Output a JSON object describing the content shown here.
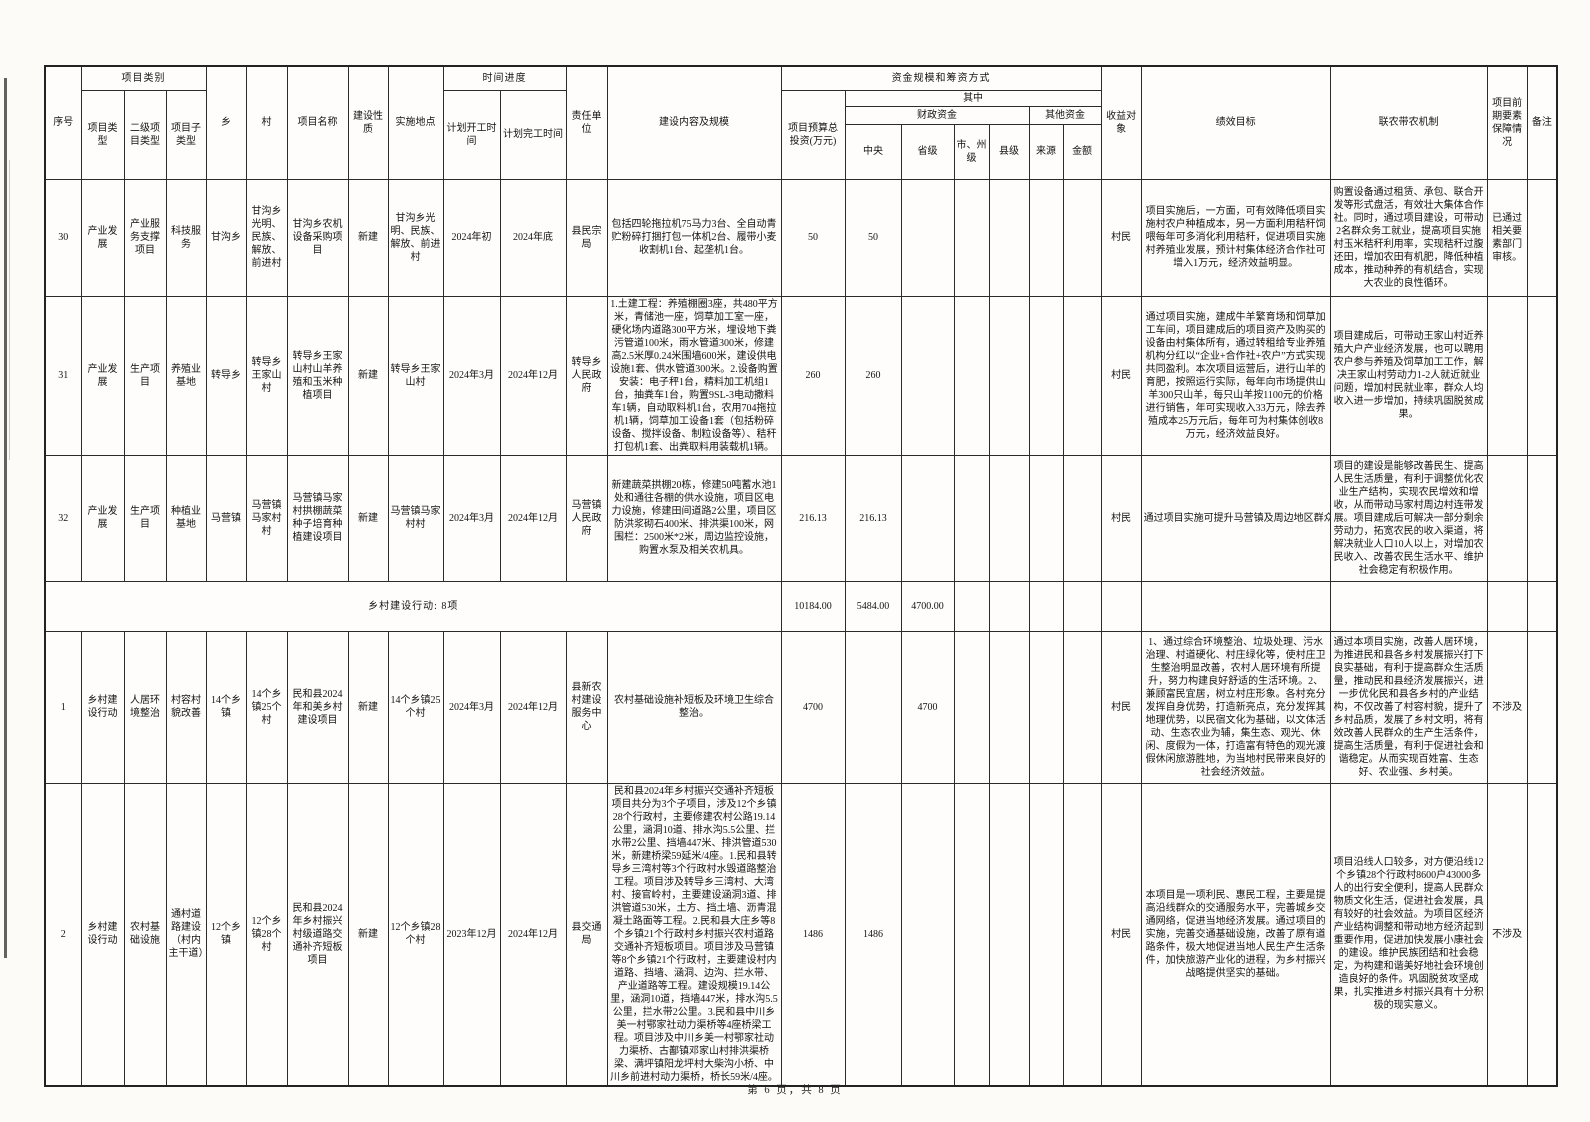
{
  "document": {
    "footer_page": "第 6 页，共 8 页"
  },
  "table": {
    "header": {
      "seq": "序号",
      "category_group": "项目类别",
      "project_type": "项目类型",
      "secondary_type": "二级项目类型",
      "sub_type": "项目子类型",
      "township": "乡",
      "village": "村",
      "project_name": "项目名称",
      "nature": "建设性质",
      "location": "实施地点",
      "schedule_group": "时间进度",
      "plan_start": "计划开工时间",
      "plan_finish": "计划完工时间",
      "responsible_unit": "责任单位",
      "content_scale": "建设内容及规模",
      "funding_group": "资金规模和筹资方式",
      "budget_total": "项目预算总投资(万元)",
      "including": "其中",
      "fiscal_funds": "财政资金",
      "central": "中央",
      "provincial": "省级",
      "city_level": "市、州级",
      "county_level": "县级",
      "other_funds": "其他资金",
      "source": "来源",
      "amount": "金额",
      "beneficiary": "收益对象",
      "performance_goal": "绩效目标",
      "mechanism": "联农带农机制",
      "preparation": "项目前期要素保障情况",
      "remark": "备注"
    },
    "rows": [
      {
        "seq": "30",
        "type": "产业发展",
        "secondary": "产业服务支撑项目",
        "subtype": "科技服务",
        "township": "甘沟乡",
        "village": "甘沟乡光明、民族、解放、前进村",
        "name": "甘沟乡农机设备采购项目",
        "nature": "新建",
        "location": "甘沟乡光明、民族、解放、前进村",
        "start": "2024年初",
        "finish": "2024年底",
        "unit": "县民宗局",
        "content": "包括四轮拖拉机75马力3台、全自动青贮粉碎打捆打包一体机2台、履带小麦收割机1台、起垄机1台。",
        "budget": "50",
        "central": "50",
        "provincial": "",
        "city": "",
        "county": "",
        "source": "",
        "amount": "",
        "beneficiary": "村民",
        "performance": "项目实施后，一方面，可有效降低项目实施村农户种植成本，另一方面利用秸秆饲喂每年可多消化利用秸秆，促进项目实施村养殖业发展，预计村集体经济合作社可增入1万元，经济效益明显。",
        "mechanism": "购置设备通过租赁、承包、联合开发等形式盘活，有效壮大集体合作社。同时，通过项目建设，可带动2名群众务工就业，提高项目实施村玉米秸秆利用率，实现秸秆过腹还田，增加农田有机肥，降低种植成本，推动种养的有机结合，实现大农业的良性循环。",
        "preparation": "已通过相关要素部门审核。",
        "remark": ""
      },
      {
        "seq": "31",
        "type": "产业发展",
        "secondary": "生产项目",
        "subtype": "养殖业基地",
        "township": "转导乡",
        "village": "转导乡王家山村",
        "name": "转导乡王家山村山羊养殖和玉米种植项目",
        "nature": "新建",
        "location": "转导乡王家山村",
        "start": "2024年3月",
        "finish": "2024年12月",
        "unit": "转导乡人民政府",
        "content": "1.土建工程：养殖棚圈3座，共480平方米，青储池一座，饲草加工室一座，硬化场内道路300平方米，埋设地下粪污管道100米，雨水管道300米，修建高2.5米厚0.24米围墙600米，建设供电设施1套、供水管道300米。2.设备购置安装：电子秤1台，精料加工机组1台，抽粪车1台，购置9SL-3电动撒料车1辆，自动取料机1台，农用704拖拉机1辆，饲草加工设备1套（包括粉碎设备、搅拌设备、制粒设备等）、秸秆打包机1套、出粪取料用装载机1辆。",
        "budget": "260",
        "central": "260",
        "provincial": "",
        "city": "",
        "county": "",
        "source": "",
        "amount": "",
        "beneficiary": "村民",
        "performance": "通过项目实施，建成牛羊繁育场和饲草加工车间，项目建成后的项目资产及购买的设备由村集体所有，通过转租给专业养殖机构分红以“企业+合作社+农户”方式实现共同盈利。本次项目运营后，进行山羊的育肥，按照运行实际，每年向市场提供山羊300只山羊，每只山羊按1100元的价格进行销售，年可实现收入33万元，除去养殖成本25万元后，每年可为村集体创收8万元，经济效益良好。",
        "mechanism": "项目建成后，可带动王家山村近养殖大户产业经济发展，也可以聘用农户参与养殖及饲草加工工作，解决王家山村劳动力1-2人就近就业问题，增加村民就业率，群众人均收入进一步增加，持续巩固脱贫成果。",
        "preparation": "",
        "remark": ""
      },
      {
        "seq": "32",
        "type": "产业发展",
        "secondary": "生产项目",
        "subtype": "种植业基地",
        "township": "马营镇",
        "village": "马营镇马家村村",
        "name": "马营镇马家村拱棚蔬菜种子培育种植建设项目",
        "nature": "新建",
        "location": "马营镇马家村村",
        "start": "2024年3月",
        "finish": "2024年12月",
        "unit": "马营镇人民政府",
        "content": "新建蔬菜拱棚20栋，修建50吨蓄水池1处和通往各棚的供水设施，项目区电力设施，修建田间道路2公里，项目区防洪浆砌石400米、排洪渠100米，网围栏：2500米*2米，周边监控设施，购置水泵及相关农机具。",
        "budget": "216.13",
        "central": "216.13",
        "provincial": "",
        "city": "",
        "county": "",
        "source": "",
        "amount": "",
        "beneficiary": "村民",
        "performance": "通过项目实施可提升马营镇及周边地区群众",
        "mechanism": "项目的建设是能够改善民生、提高人民生活质量，有利于调整优化农业生产结构，实现农民增效和增收，从而带动马家村周边村连带发展。项目建成后可解决一部分剩余劳动力，拓宽农民的收入渠道，将解决就业人口10人以上，对增加农民收入、改善农民生活水平、维护社会稳定有积极作用。",
        "preparation": "",
        "remark": ""
      }
    ],
    "section_total": {
      "label": "乡村建设行动: 8项",
      "budget": "10184.00",
      "central": "5484.00",
      "provincial": "4700.00"
    },
    "rows2": [
      {
        "seq": "1",
        "type": "乡村建设行动",
        "secondary": "人居环境整治",
        "subtype": "村容村貌改善",
        "township": "14个乡镇",
        "village": "14个乡镇25个村",
        "name": "民和县2024年和美乡村建设项目",
        "nature": "新建",
        "location": "14个乡镇25个村",
        "start": "2024年3月",
        "finish": "2024年12月",
        "unit": "县新农村建设服务中心",
        "content": "农村基础设施补短板及环境卫生综合整治。",
        "budget": "4700",
        "central": "",
        "provincial": "4700",
        "city": "",
        "county": "",
        "source": "",
        "amount": "",
        "beneficiary": "村民",
        "performance": "1、通过综合环境整治、垃圾处理、污水治理、村道硬化、村庄绿化等，使村庄卫生整治明显改善，农村人居环境有所提升，努力构建良好舒适的生活环境。2、兼顾富民宜居，树立村庄形象。各村充分发挥自身优势，打造新亮点，充分发挥其地理优势，以民宿文化为基础，以文体活动、生态农业为辅，集生态、观光、休闲、度假为一体，打造富有特色的观光渡假休闲旅游胜地，为当地村民带来良好的社会经济效益。",
        "mechanism": "通过本项目实施，改善人居环境，为推进民和县各乡村发展振兴打下良实基础，有利于提高群众生活质量，推动民和县经济发展振兴，进一步优化民和县各乡村的产业结构，不仅改善了村容村貌，提升了乡村品质，发展了乡村文明，将有效改善人民群众的生产生活条件，提高生活质量，有利于促进社会和谐稳定。从而实现百姓富、生态好、农业强、乡村美。",
        "preparation": "不涉及",
        "remark": ""
      },
      {
        "seq": "2",
        "type": "乡村建设行动",
        "secondary": "农村基础设施",
        "subtype": "通村道路建设（村内主干道）",
        "township": "12个乡镇",
        "village": "12个乡镇28个村",
        "name": "民和县2024年乡村振兴村级道路交通补齐短板项目",
        "nature": "新建",
        "location": "12个乡镇28个村",
        "start": "2023年12月",
        "finish": "2024年12月",
        "unit": "县交通局",
        "content": "民和县2024年乡村振兴交通补齐短板项目共分为3个子项目，涉及12个乡镇28个行政村，主要修建农村公路19.14公里，涵洞10道、排水沟5.5公里、拦水带2公里、挡墙447米、排洪管道530米，新建桥梁59延米/4座。1.民和县转导乡三湾村等3个行政村水毁道路整治工程。项目涉及转导乡三湾村、大湾村、接官岭村，主要建设涵洞3道、排洪管道530米，土方、挡土墙、沥青混凝土路面等工程。2.民和县大庄乡等8个乡镇21个行政村乡村振兴农村道路交通补齐短板项目。项目涉及马营镇等8个乡镇21个行政村，主要建设村内道路、挡墙、涵洞、边沟、拦水带、产业道路等工程。建设规模19.14公里，涵洞10道，挡墙447米，排水沟5.5公里，拦水带2公里。3.民和县中川乡美一村鄂家社动力渠桥等4座桥梁工程。项目涉及中川乡美一村鄂家社动力渠桥、古鄯镇邓家山村排洪渠桥梁、满坪镇阳龙坪村大柴沟小桥、中川乡前进村动力渠桥，桥长59米/4座。",
        "budget": "1486",
        "central": "1486",
        "provincial": "",
        "city": "",
        "county": "",
        "source": "",
        "amount": "",
        "beneficiary": "村民",
        "performance": "本项目是一项利民、惠民工程，主要是提高沿线群众的交通服务水平，完善城乡交通网络，促进当地经济发展。通过项目的实施，完善交通基础设施，改善了原有道路条件，极大地促进当地人民生产生活条件，加快旅游产业化的进程，为乡村振兴战略提供坚实的基础。",
        "mechanism": "项目沿线人口较多，对方便沿线12个乡镇28个行政村8600户43000多人的出行安全便利，提高人民群众物质文化生活，促进社会发展，具有较好的社会效益。为项目区经济产业结构调整和带动地方经济起到重要作用，促进加快发展小康社会的建设。维护民族团结和社会稳定，为构建和谐美好地社会环境创造良好的条件。巩固脱贫攻坚成果，扎实推进乡村振兴具有十分积极的现实意义。",
        "preparation": "不涉及",
        "remark": ""
      }
    ]
  }
}
